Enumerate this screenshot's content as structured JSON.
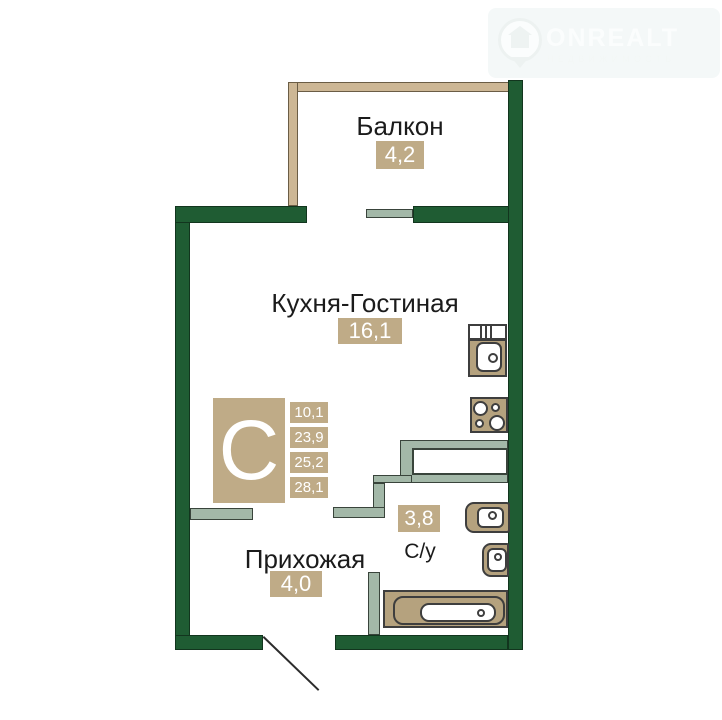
{
  "watermark": {
    "brand": "ONREALT",
    "tagline": "НЕДВИЖИМОСТЬ"
  },
  "rooms": {
    "balcony": {
      "label": "Балкон",
      "area": "4,2"
    },
    "kitchen_living": {
      "label": "Кухня-Гостиная",
      "area": "16,1"
    },
    "hallway": {
      "label": "Прихожая",
      "area": "4,0"
    },
    "bathroom": {
      "label": "С/у",
      "area": "3,8"
    }
  },
  "badge": {
    "letter": "С",
    "areas": [
      "10,1",
      "23,9",
      "25,2",
      "28,1"
    ]
  },
  "colors": {
    "wall_green": "#1f5c33",
    "partition_sage": "#a3b8a8",
    "balcony_beige": "#cdb795",
    "fixture_beige": "#b5a27e",
    "label_box_beige": "#bfab87",
    "watermark_tint": "rgba(42,110,110,0.05)"
  }
}
